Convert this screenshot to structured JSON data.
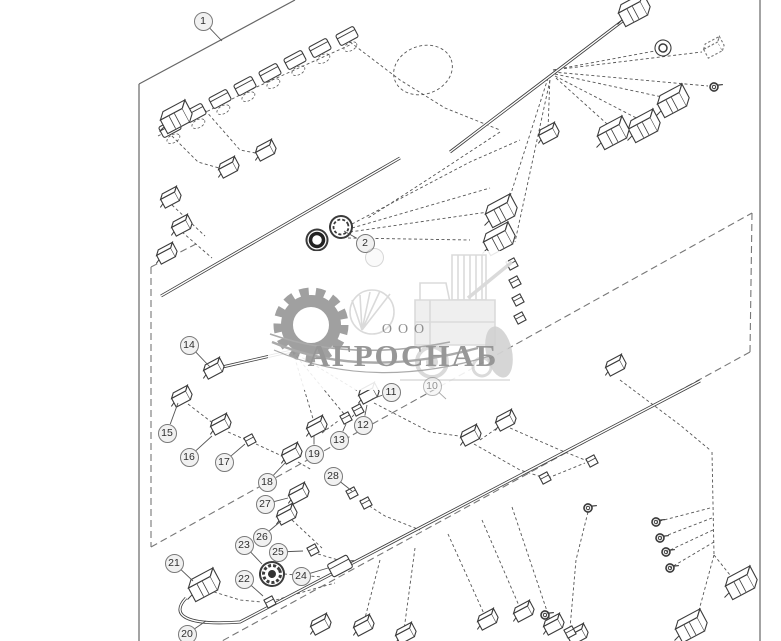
{
  "watermark": {
    "prefix": "ООО",
    "name": "АГРОСНАБ"
  },
  "colors": {
    "line": "#3b3b3b",
    "wire": "#555555",
    "border": "#666666",
    "balloon_fill": "#f1f1f1",
    "balloon_stroke": "#7a7a7a",
    "watermark_gray": "#929292",
    "watermark_light": "#d9d9d9"
  },
  "callouts": [
    {
      "num": "1",
      "x": 203,
      "y": 21,
      "lx": 222,
      "ly": 41,
      "style": "normal"
    },
    {
      "num": "2",
      "x": 365,
      "y": 243,
      "lx": 344,
      "ly": 231,
      "style": "normal"
    },
    {
      "num": "",
      "x": 374,
      "y": 257,
      "lx": 0,
      "ly": 0,
      "style": "under"
    },
    {
      "num": "10",
      "x": 432,
      "y": 386,
      "lx": 446,
      "ly": 399,
      "style": "faded"
    },
    {
      "num": "11",
      "x": 391,
      "y": 392,
      "lx": 372,
      "ly": 399,
      "style": "normal"
    },
    {
      "num": "12",
      "x": 363,
      "y": 425,
      "lx": 367,
      "ly": 405,
      "style": "normal"
    },
    {
      "num": "13",
      "x": 339,
      "y": 440,
      "lx": 346,
      "ly": 424,
      "style": "normal"
    },
    {
      "num": "14",
      "x": 189,
      "y": 345,
      "lx": 210,
      "ly": 367,
      "style": "normal"
    },
    {
      "num": "15",
      "x": 167,
      "y": 433,
      "lx": 178,
      "ly": 403,
      "style": "normal"
    },
    {
      "num": "16",
      "x": 189,
      "y": 457,
      "lx": 212,
      "ly": 436,
      "style": "normal"
    },
    {
      "num": "17",
      "x": 224,
      "y": 462,
      "lx": 245,
      "ly": 444,
      "style": "normal"
    },
    {
      "num": "18",
      "x": 267,
      "y": 482,
      "lx": 285,
      "ly": 463,
      "style": "normal"
    },
    {
      "num": "19",
      "x": 314,
      "y": 454,
      "lx": 314,
      "ly": 436,
      "style": "normal"
    },
    {
      "num": "20",
      "x": 187,
      "y": 634,
      "lx": 206,
      "ly": 621,
      "style": "normal"
    },
    {
      "num": "21",
      "x": 174,
      "y": 563,
      "lx": 193,
      "ly": 581,
      "style": "normal"
    },
    {
      "num": "22",
      "x": 244,
      "y": 579,
      "lx": 263,
      "ly": 596,
      "style": "normal"
    },
    {
      "num": "23",
      "x": 244,
      "y": 545,
      "lx": 262,
      "ly": 564,
      "style": "normal"
    },
    {
      "num": "24",
      "x": 301,
      "y": 576,
      "lx": 328,
      "ly": 568,
      "style": "normal"
    },
    {
      "num": "25",
      "x": 278,
      "y": 552,
      "lx": 303,
      "ly": 551,
      "style": "normal"
    },
    {
      "num": "26",
      "x": 262,
      "y": 537,
      "lx": 281,
      "ly": 521,
      "style": "normal"
    },
    {
      "num": "27",
      "x": 265,
      "y": 504,
      "lx": 288,
      "ly": 498,
      "style": "normal"
    },
    {
      "num": "28",
      "x": 333,
      "y": 476,
      "lx": 352,
      "ly": 491,
      "style": "normal"
    }
  ],
  "diagram": {
    "solid_lines": [
      [
        139,
        84,
        295,
        0
      ],
      [
        139,
        84,
        139,
        641
      ],
      [
        760,
        0,
        760,
        641
      ]
    ],
    "dashed_lines": [
      [
        151,
        267,
        151,
        547
      ],
      [
        151,
        267,
        196,
        244
      ],
      [
        151,
        547,
        752,
        213
      ],
      [
        752,
        213,
        750,
        352
      ],
      [
        750,
        352,
        222,
        641
      ]
    ],
    "trunk_paths": [
      "M161,296 L400,158",
      "M450,152 L633,13",
      "M186,598 C170,615 185,626 240,622 L700,381",
      "M218,368 L292,351"
    ],
    "loops": [
      {
        "cx": 423,
        "cy": 70,
        "rx": 30,
        "ry": 24,
        "rot": -20
      }
    ],
    "wires": [
      [
        350,
        42,
        400,
        80,
        445,
        108,
        500,
        130
      ],
      [
        158,
        136,
        250,
        90,
        352,
        44
      ],
      [
        168,
        132,
        198,
        162,
        226,
        170
      ],
      [
        205,
        110,
        240,
        150,
        266,
        155
      ],
      [
        172,
        205,
        205,
        236
      ],
      [
        182,
        232,
        212,
        258
      ],
      [
        352,
        224,
        470,
        162,
        520,
        140
      ],
      [
        352,
        228,
        490,
        188
      ],
      [
        350,
        232,
        488,
        212
      ],
      [
        348,
        238,
        470,
        240
      ],
      [
        500,
        132,
        430,
        178,
        368,
        218
      ],
      [
        553,
        70,
        660,
        50
      ],
      [
        553,
        70,
        702,
        52
      ],
      [
        553,
        72,
        708,
        86
      ],
      [
        555,
        74,
        676,
        100
      ],
      [
        555,
        76,
        648,
        124
      ],
      [
        556,
        78,
        616,
        132
      ],
      [
        550,
        75,
        548,
        130
      ],
      [
        548,
        78,
        505,
        212
      ],
      [
        550,
        80,
        515,
        242
      ],
      [
        293,
        352,
        314,
        422
      ],
      [
        293,
        352,
        344,
        414
      ],
      [
        293,
        352,
        366,
        396
      ],
      [
        188,
        404,
        214,
        424
      ],
      [
        228,
        432,
        246,
        440
      ],
      [
        256,
        444,
        282,
        456
      ],
      [
        298,
        462,
        312,
        470
      ],
      [
        322,
        433,
        338,
        421
      ],
      [
        352,
        417,
        362,
        406
      ],
      [
        374,
        403,
        430,
        432,
        466,
        437
      ],
      [
        480,
        440,
        500,
        426
      ],
      [
        510,
        428,
        560,
        450,
        590,
        462
      ],
      [
        474,
        444,
        520,
        470,
        545,
        478
      ],
      [
        360,
        500,
        385,
        516,
        420,
        530
      ],
      [
        276,
        600,
        310,
        590,
        335,
        583
      ],
      [
        284,
        574,
        322,
        577
      ],
      [
        318,
        554,
        345,
        562
      ],
      [
        292,
        520,
        322,
        548
      ],
      [
        214,
        592,
        240,
        600,
        262,
        602
      ],
      [
        380,
        560,
        364,
        622
      ],
      [
        415,
        548,
        404,
        630
      ],
      [
        448,
        534,
        485,
        616
      ],
      [
        482,
        520,
        520,
        608
      ],
      [
        512,
        507,
        550,
        620
      ],
      [
        620,
        380,
        680,
        425,
        710,
        450
      ],
      [
        712,
        452,
        714,
        555
      ],
      [
        714,
        555,
        738,
        585
      ],
      [
        714,
        555,
        695,
        625
      ],
      [
        710,
        508,
        656,
        522
      ],
      [
        712,
        518,
        660,
        538
      ],
      [
        713,
        530,
        666,
        552
      ],
      [
        714,
        542,
        670,
        568
      ],
      [
        548,
        478,
        585,
        463
      ],
      [
        588,
        512,
        576,
        560,
        570,
        628
      ]
    ],
    "connectors": [
      {
        "t": "clip",
        "x": 170,
        "y": 128
      },
      {
        "t": "clip",
        "x": 195,
        "y": 113
      },
      {
        "t": "clip",
        "x": 220,
        "y": 99
      },
      {
        "t": "clip",
        "x": 245,
        "y": 86
      },
      {
        "t": "clip",
        "x": 270,
        "y": 73
      },
      {
        "t": "clip",
        "x": 295,
        "y": 60
      },
      {
        "t": "clip",
        "x": 320,
        "y": 48
      },
      {
        "t": "clip",
        "x": 347,
        "y": 36
      },
      {
        "t": "big",
        "x": 175,
        "y": 121
      },
      {
        "t": "box",
        "x": 170,
        "y": 200
      },
      {
        "t": "box",
        "x": 181,
        "y": 228
      },
      {
        "t": "box",
        "x": 166,
        "y": 256
      },
      {
        "t": "box",
        "x": 228,
        "y": 170
      },
      {
        "t": "box",
        "x": 265,
        "y": 153
      },
      {
        "t": "ring2",
        "x": 341,
        "y": 227
      },
      {
        "t": "cap",
        "x": 317,
        "y": 240
      },
      {
        "t": "big",
        "x": 500,
        "y": 215
      },
      {
        "t": "big",
        "x": 498,
        "y": 243
      },
      {
        "t": "sq",
        "x": 512,
        "y": 264
      },
      {
        "t": "sq",
        "x": 515,
        "y": 282
      },
      {
        "t": "sq",
        "x": 518,
        "y": 300
      },
      {
        "t": "sq",
        "x": 520,
        "y": 318
      },
      {
        "t": "big",
        "x": 633,
        "y": 14
      },
      {
        "t": "round",
        "x": 663,
        "y": 48
      },
      {
        "t": "ghost",
        "x": 713,
        "y": 50
      },
      {
        "t": "ring",
        "x": 714,
        "y": 87
      },
      {
        "t": "big",
        "x": 672,
        "y": 105
      },
      {
        "t": "big",
        "x": 643,
        "y": 130
      },
      {
        "t": "big",
        "x": 612,
        "y": 137
      },
      {
        "t": "box",
        "x": 548,
        "y": 136
      },
      {
        "t": "box",
        "x": 213,
        "y": 371
      },
      {
        "t": "box",
        "x": 181,
        "y": 399
      },
      {
        "t": "box",
        "x": 220,
        "y": 427
      },
      {
        "t": "sq",
        "x": 250,
        "y": 440
      },
      {
        "t": "box",
        "x": 291,
        "y": 456
      },
      {
        "t": "box",
        "x": 316,
        "y": 429
      },
      {
        "t": "box",
        "x": 368,
        "y": 396
      },
      {
        "t": "sq",
        "x": 358,
        "y": 410
      },
      {
        "t": "sq",
        "x": 346,
        "y": 418
      },
      {
        "t": "box",
        "x": 470,
        "y": 438
      },
      {
        "t": "box",
        "x": 505,
        "y": 423
      },
      {
        "t": "sq",
        "x": 592,
        "y": 461
      },
      {
        "t": "sq",
        "x": 545,
        "y": 478
      },
      {
        "t": "box",
        "x": 298,
        "y": 496
      },
      {
        "t": "sq",
        "x": 352,
        "y": 493
      },
      {
        "t": "sq",
        "x": 366,
        "y": 503
      },
      {
        "t": "box",
        "x": 286,
        "y": 517
      },
      {
        "t": "sq",
        "x": 313,
        "y": 550
      },
      {
        "t": "knob",
        "x": 272,
        "y": 574
      },
      {
        "t": "flash",
        "x": 340,
        "y": 566
      },
      {
        "t": "sq",
        "x": 270,
        "y": 602
      },
      {
        "t": "big",
        "x": 203,
        "y": 589
      },
      {
        "t": "box",
        "x": 615,
        "y": 368
      },
      {
        "t": "box",
        "x": 320,
        "y": 627
      },
      {
        "t": "box",
        "x": 363,
        "y": 628
      },
      {
        "t": "box",
        "x": 405,
        "y": 636
      },
      {
        "t": "box",
        "x": 487,
        "y": 622
      },
      {
        "t": "box",
        "x": 523,
        "y": 614
      },
      {
        "t": "box",
        "x": 553,
        "y": 627
      },
      {
        "t": "box",
        "x": 577,
        "y": 637
      },
      {
        "t": "big",
        "x": 740,
        "y": 587
      },
      {
        "t": "big",
        "x": 690,
        "y": 630
      },
      {
        "t": "ring",
        "x": 588,
        "y": 508
      },
      {
        "t": "ring",
        "x": 656,
        "y": 522
      },
      {
        "t": "ring",
        "x": 660,
        "y": 538
      },
      {
        "t": "ring",
        "x": 666,
        "y": 552
      },
      {
        "t": "ring",
        "x": 670,
        "y": 568
      },
      {
        "t": "ring",
        "x": 545,
        "y": 615
      },
      {
        "t": "sq",
        "x": 570,
        "y": 632
      }
    ]
  }
}
